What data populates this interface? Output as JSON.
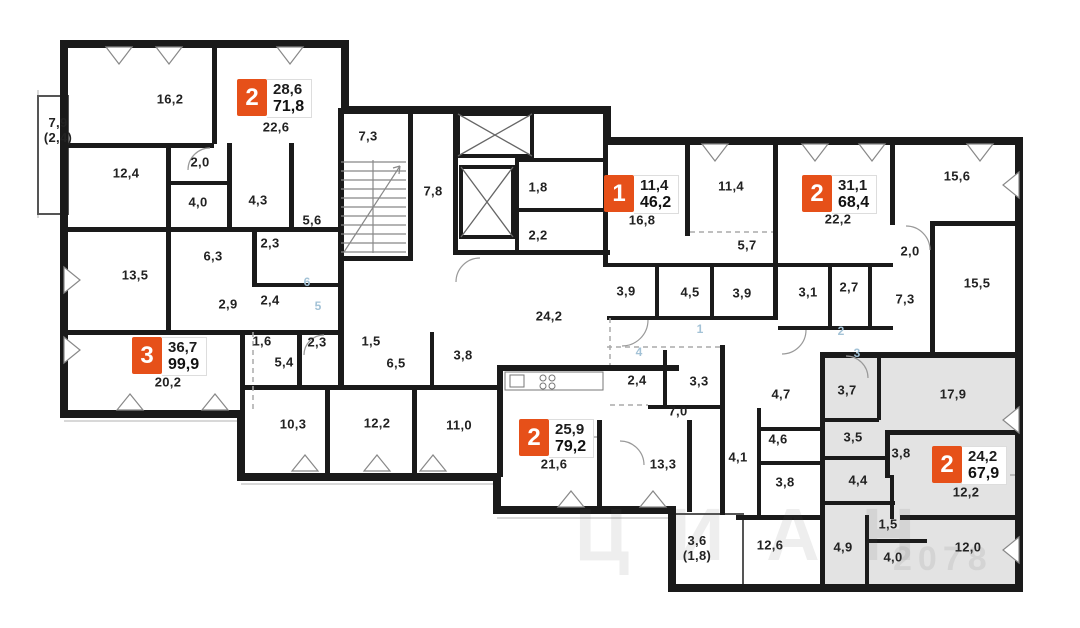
{
  "plan": {
    "background_color": "#ffffff",
    "wall_color": "#1a1a1a",
    "highlight_fill": "#e3e3e3",
    "badge_color": "#e65019",
    "marker_color": "#a3c2d6"
  },
  "watermark": {
    "brand": "ЦИАН",
    "id": "2078"
  },
  "apartments": [
    {
      "badge": "2",
      "living": "28,6",
      "total": "71,8",
      "x": 237,
      "y": 79
    },
    {
      "badge": "3",
      "living": "36,7",
      "total": "99,9",
      "x": 132,
      "y": 337
    },
    {
      "badge": "1",
      "living": "11,4",
      "total": "46,2",
      "x": 604,
      "y": 175
    },
    {
      "badge": "2",
      "living": "31,1",
      "total": "68,4",
      "x": 802,
      "y": 175
    },
    {
      "badge": "2",
      "living": "25,9",
      "total": "79,2",
      "x": 519,
      "y": 419
    },
    {
      "badge": "2",
      "living": "24,2",
      "total": "67,9",
      "x": 932,
      "y": 446
    }
  ],
  "room_labels": [
    {
      "t": "16,2",
      "x": 170,
      "y": 100
    },
    {
      "t": "7,9\n(2,4)",
      "x": 58,
      "y": 131
    },
    {
      "t": "12,4",
      "x": 126,
      "y": 174
    },
    {
      "t": "22,6",
      "x": 276,
      "y": 128
    },
    {
      "t": "2,0",
      "x": 200,
      "y": 163
    },
    {
      "t": "4,0",
      "x": 198,
      "y": 203
    },
    {
      "t": "4,3",
      "x": 258,
      "y": 201
    },
    {
      "t": "5,6",
      "x": 312,
      "y": 221
    },
    {
      "t": "2,3",
      "x": 270,
      "y": 244
    },
    {
      "t": "6,3",
      "x": 213,
      "y": 257
    },
    {
      "t": "13,5",
      "x": 135,
      "y": 276
    },
    {
      "t": "2,9",
      "x": 228,
      "y": 305
    },
    {
      "t": "2,4",
      "x": 270,
      "y": 301
    },
    {
      "t": "1,6",
      "x": 262,
      "y": 342
    },
    {
      "t": "2,3",
      "x": 317,
      "y": 343
    },
    {
      "t": "5,4",
      "x": 284,
      "y": 363
    },
    {
      "t": "20,2",
      "x": 168,
      "y": 383
    },
    {
      "t": "10,3",
      "x": 293,
      "y": 425
    },
    {
      "t": "12,2",
      "x": 377,
      "y": 424
    },
    {
      "t": "11,0",
      "x": 459,
      "y": 426
    },
    {
      "t": "1,5",
      "x": 371,
      "y": 342
    },
    {
      "t": "6,5",
      "x": 396,
      "y": 364
    },
    {
      "t": "3,8",
      "x": 463,
      "y": 356
    },
    {
      "t": "7,3",
      "x": 368,
      "y": 137
    },
    {
      "t": "7,8",
      "x": 433,
      "y": 192
    },
    {
      "t": "1,8",
      "x": 538,
      "y": 188
    },
    {
      "t": "2,2",
      "x": 538,
      "y": 236
    },
    {
      "t": "24,2",
      "x": 549,
      "y": 317
    },
    {
      "t": "16,8",
      "x": 642,
      "y": 221
    },
    {
      "t": "11,4",
      "x": 731,
      "y": 187
    },
    {
      "t": "5,7",
      "x": 747,
      "y": 246
    },
    {
      "t": "3,9",
      "x": 626,
      "y": 292
    },
    {
      "t": "4,5",
      "x": 690,
      "y": 293
    },
    {
      "t": "3,9",
      "x": 742,
      "y": 294
    },
    {
      "t": "22,2",
      "x": 838,
      "y": 220
    },
    {
      "t": "3,1",
      "x": 808,
      "y": 293
    },
    {
      "t": "2,7",
      "x": 849,
      "y": 288
    },
    {
      "t": "7,3",
      "x": 905,
      "y": 300
    },
    {
      "t": "2,0",
      "x": 910,
      "y": 252
    },
    {
      "t": "15,6",
      "x": 957,
      "y": 177
    },
    {
      "t": "15,5",
      "x": 977,
      "y": 284
    },
    {
      "t": "2,4",
      "x": 637,
      "y": 381
    },
    {
      "t": "3,3",
      "x": 699,
      "y": 382
    },
    {
      "t": "7,0",
      "x": 678,
      "y": 412
    },
    {
      "t": "21,6",
      "x": 554,
      "y": 465
    },
    {
      "t": "13,3",
      "x": 663,
      "y": 465
    },
    {
      "t": "4,1",
      "x": 738,
      "y": 458
    },
    {
      "t": "4,7",
      "x": 781,
      "y": 395
    },
    {
      "t": "4,6",
      "x": 778,
      "y": 440
    },
    {
      "t": "3,8",
      "x": 785,
      "y": 483
    },
    {
      "t": "3,6\n(1,8)",
      "x": 697,
      "y": 549
    },
    {
      "t": "12,6",
      "x": 770,
      "y": 546
    },
    {
      "t": "3,7",
      "x": 847,
      "y": 391
    },
    {
      "t": "3,5",
      "x": 853,
      "y": 438
    },
    {
      "t": "3,8",
      "x": 901,
      "y": 454
    },
    {
      "t": "4,4",
      "x": 858,
      "y": 481
    },
    {
      "t": "1,5",
      "x": 888,
      "y": 525
    },
    {
      "t": "4,9",
      "x": 843,
      "y": 548
    },
    {
      "t": "4,0",
      "x": 893,
      "y": 558
    },
    {
      "t": "17,9",
      "x": 953,
      "y": 395
    },
    {
      "t": "12,2",
      "x": 966,
      "y": 493
    },
    {
      "t": "12,0",
      "x": 968,
      "y": 548
    }
  ],
  "section_markers": [
    {
      "t": "1",
      "x": 700,
      "y": 329
    },
    {
      "t": "2",
      "x": 841,
      "y": 331
    },
    {
      "t": "3",
      "x": 857,
      "y": 353
    },
    {
      "t": "4",
      "x": 639,
      "y": 352
    },
    {
      "t": "5",
      "x": 318,
      "y": 306
    },
    {
      "t": "6",
      "x": 307,
      "y": 282
    }
  ]
}
